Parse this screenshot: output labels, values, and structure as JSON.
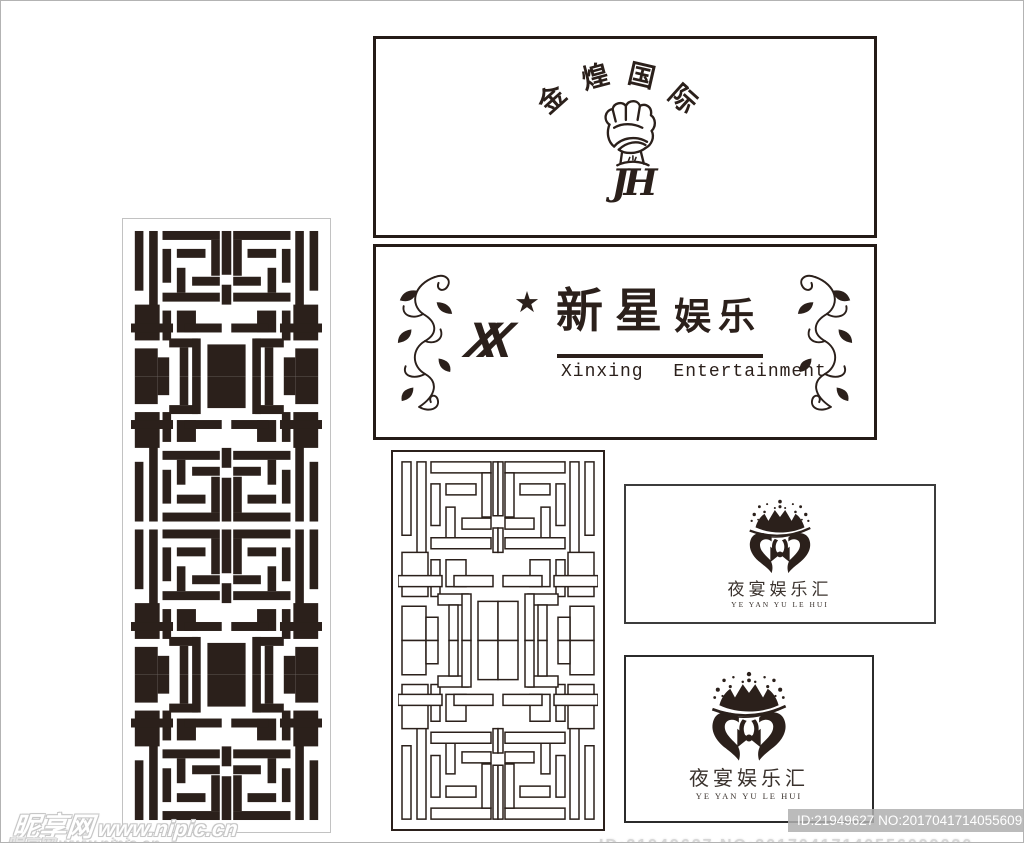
{
  "page": {
    "bg": "#ffffff",
    "edge": "#b3b3b3",
    "ink": "#2b201b"
  },
  "boxes": {
    "jinhuang": {
      "arc_chars": [
        "金",
        "煌",
        "国",
        "际"
      ],
      "monogram": "JH"
    },
    "xinxing": {
      "star": "★",
      "monogram_letters": [
        "X",
        "X"
      ],
      "name_cn_1": "新星",
      "name_cn_2": "娱乐",
      "name_en": "Xinxing Entertainment"
    },
    "yeyan": {
      "name_cn": "夜宴娱乐汇",
      "name_en": "YE YAN YU LE HUI"
    }
  },
  "watermarks": {
    "site_name": "昵享网",
    "site_url": "www.nipic.cn",
    "id_bar": "ID:21949627 NO:20170417140556099030",
    "bottom_clipped": "ID:21949627 NO:20170417140556099030",
    "bottom_left_clipped": "昵享网 www.nipic.cn"
  },
  "lattice": {
    "unit_w": 200,
    "unit_h": 300,
    "quarter_rects": [
      [
        4,
        4,
        9,
        60
      ],
      [
        19,
        4,
        9,
        88
      ],
      [
        33,
        4,
        60,
        9
      ],
      [
        84,
        13,
        9,
        36
      ],
      [
        33,
        22,
        9,
        34
      ],
      [
        48,
        22,
        30,
        9
      ],
      [
        48,
        41,
        9,
        25
      ],
      [
        64,
        50,
        29,
        9
      ],
      [
        33,
        66,
        60,
        9
      ],
      [
        95,
        4,
        5,
        44
      ],
      [
        95,
        58,
        5,
        20
      ],
      [
        4,
        78,
        26,
        36
      ],
      [
        33,
        84,
        9,
        30
      ],
      [
        48,
        84,
        20,
        22
      ],
      [
        0,
        97,
        44,
        9
      ],
      [
        56,
        97,
        39,
        9
      ],
      [
        40,
        112,
        30,
        9
      ],
      [
        51,
        121,
        9,
        29
      ],
      [
        80,
        118,
        20,
        32
      ],
      [
        64,
        112,
        9,
        38
      ],
      [
        4,
        122,
        24,
        28
      ],
      [
        28,
        131,
        12,
        19
      ]
    ]
  }
}
